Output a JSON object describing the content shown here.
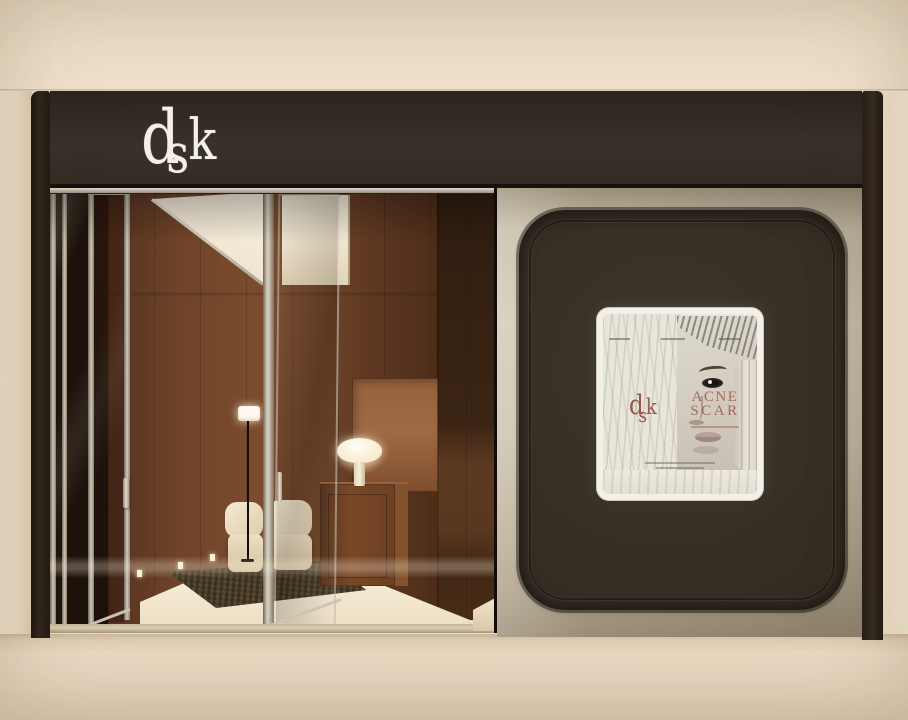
{
  "scene": {
    "description": "3D render of a dsk skin-clinic storefront: dark brown fascia with white dsk logo, open glass doors revealing a warm wood interior with lounge chairs, floor lamp, cabinet with mushroom table lamp, and a champagne-metal display panel with rounded dark inset holding an illuminated ACNE SCAR poster screen.",
    "sign": {
      "logo": {
        "d": "d",
        "s": "s",
        "k": "k"
      }
    },
    "display": {
      "poster": {
        "brand": {
          "d": "d",
          "s": "s",
          "k": "k"
        },
        "headline": {
          "line1": "ACNE",
          "line2": "SCAR"
        }
      }
    },
    "palette": {
      "wall_cream": "#eee0c9",
      "fascia_brown": "#352c24",
      "pillar_brown": "#26201a",
      "metal_champagne": "#cbc0aa",
      "inset_brown": "#362e24",
      "wood_warm": "#6f432a",
      "floor_cream": "#f3e9d4",
      "ground_beige": "#ebdac4",
      "poster_paper": "#e9e6dd",
      "poster_accent": "#a7695b",
      "lamp_glow": "#fff8e6",
      "logo_white": "#f3f0e7"
    },
    "interior_objects": [
      "floor-lamp",
      "table-lamp",
      "lounge-chairs",
      "wood-cabinet",
      "area-rug",
      "glass-doors"
    ]
  }
}
